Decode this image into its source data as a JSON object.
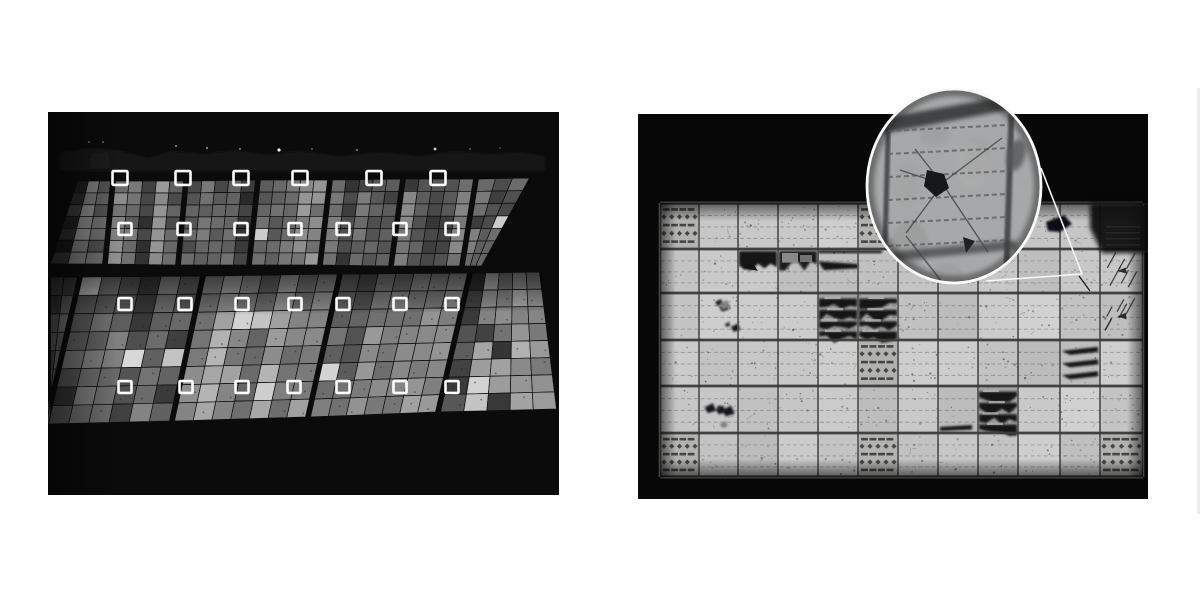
{
  "canvas": {
    "width": 1200,
    "height": 600,
    "background": "#ffffff"
  },
  "figure": {
    "left_label": "aerial electroluminescence image of solar farm with defect marker boxes",
    "right_label": "electroluminescence close-up of one PV module with magnifier inset on a cracked cell"
  },
  "left_photo": {
    "x": 48,
    "y": 112,
    "width": 511,
    "height": 383,
    "background": "#0b0b0b",
    "horizon": {
      "ridge": [
        [
          60,
          171
        ],
        [
          60,
          153
        ],
        [
          88,
          148
        ],
        [
          118,
          150
        ],
        [
          148,
          158
        ],
        [
          172,
          151
        ],
        [
          205,
          154
        ],
        [
          235,
          150
        ],
        [
          268,
          155
        ],
        [
          300,
          151
        ],
        [
          340,
          156
        ],
        [
          380,
          152
        ],
        [
          420,
          156
        ],
        [
          455,
          151
        ],
        [
          490,
          154
        ],
        [
          520,
          152
        ],
        [
          545,
          156
        ],
        [
          545,
          171
        ]
      ],
      "ridge_color": "#151515",
      "patch": [
        [
          90,
          168
        ],
        [
          92,
          153
        ],
        [
          108,
          152
        ],
        [
          110,
          168
        ]
      ],
      "patch_color": "#1e1e1e",
      "dots": [
        [
          89,
          142,
          0.9,
          0.5
        ],
        [
          103,
          142,
          0.9,
          0.5
        ],
        [
          176,
          146,
          1,
          0.55
        ],
        [
          207,
          148,
          1,
          0.6
        ],
        [
          240,
          149,
          1,
          0.5
        ],
        [
          279,
          150,
          1.6,
          0.95
        ],
        [
          312,
          149,
          0.9,
          0.45
        ],
        [
          357,
          150,
          1,
          0.5
        ],
        [
          435,
          149,
          1.4,
          0.8
        ],
        [
          470,
          149,
          0.9,
          0.45
        ],
        [
          500,
          148,
          0.8,
          0.4
        ]
      ]
    },
    "row_top": {
      "edges": [
        [
          75,
          181,
          48,
          264
        ],
        [
          113,
          181,
          105,
          264
        ],
        [
          186,
          181,
          178,
          265
        ],
        [
          258,
          180,
          249,
          265
        ],
        [
          330,
          180,
          320,
          265
        ],
        [
          403,
          179,
          391,
          266
        ],
        [
          476,
          179,
          462,
          266
        ],
        [
          532,
          178,
          484,
          266
        ]
      ],
      "cell_w": 12.5,
      "cell_rows": 7,
      "brightness": [
        0.8,
        0.95,
        0.9,
        1.0,
        0.92,
        0.88,
        0.9
      ]
    },
    "row_bottom": {
      "edges": [
        [
          48,
          277,
          48,
          425
        ],
        [
          80,
          277,
          46,
          424
        ],
        [
          203,
          276,
          172,
          421
        ],
        [
          340,
          274,
          308,
          417
        ],
        [
          470,
          273,
          438,
          412
        ],
        [
          542,
          272,
          559,
          409
        ]
      ],
      "cell_w": 19,
      "cell_rows": 8,
      "brightness": [
        0.72,
        0.9,
        1.0,
        0.93,
        1.2
      ],
      "shadow_band": [
        [
          48,
          277
        ],
        [
          542,
          272
        ],
        [
          544,
          310
        ],
        [
          48,
          318
        ]
      ]
    },
    "markers": {
      "stroke": "#fcfcfc",
      "stroke_width": 2.6,
      "rows": [
        {
          "cy": 178,
          "size": 15,
          "xs": [
            120,
            183,
            241,
            300,
            374,
            438
          ]
        },
        {
          "cy": 229,
          "size": 13,
          "xs": [
            125,
            184,
            241,
            295,
            343,
            400,
            452
          ]
        },
        {
          "cy": 304,
          "size": 13,
          "xs": [
            125,
            185,
            242,
            295,
            343,
            400,
            452
          ]
        },
        {
          "cy": 387,
          "size": 13,
          "xs": [
            125,
            186,
            242,
            294,
            343,
            400,
            452
          ]
        }
      ]
    }
  },
  "right_photo": {
    "x": 638,
    "y": 85,
    "width": 510,
    "height": 414,
    "photo_top": 114,
    "photo_bottom": 499,
    "background": "#070707",
    "module": {
      "col_edges": [
        660,
        699,
        738,
        778,
        818,
        858,
        898,
        938,
        978,
        1018,
        1060,
        1100,
        1143
      ],
      "row_edges": [
        203,
        249,
        293,
        340,
        386,
        433,
        477
      ],
      "cell_fill": "#c7c8c6",
      "grid_color": "#4c4c4a",
      "row_line_color": "#3b3b39",
      "busbar_color": "#5a5a58",
      "speckle_count": 560,
      "scratch_count": 55
    },
    "pattern_cells": [
      [
        0,
        0
      ],
      [
        0,
        5
      ],
      [
        3,
        5
      ],
      [
        5,
        0
      ],
      [
        5,
        5
      ],
      [
        5,
        11
      ]
    ],
    "defects": [
      {
        "row": 1,
        "col": 2,
        "type": "band"
      },
      {
        "row": 1,
        "col": 3,
        "type": "band-mixed"
      },
      {
        "row": 1,
        "col": 4,
        "type": "wedge-left"
      },
      {
        "row": 2,
        "col": 1,
        "type": "blobs"
      },
      {
        "row": 2,
        "col": 4,
        "type": "shatter"
      },
      {
        "row": 2,
        "col": 5,
        "type": "shatter"
      },
      {
        "row": 1,
        "col": 11,
        "type": "scratches"
      },
      {
        "row": 2,
        "col": 11,
        "type": "scratches"
      },
      {
        "row": 3,
        "col": 10,
        "type": "wedges"
      },
      {
        "row": 4,
        "col": 1,
        "type": "blobs"
      },
      {
        "row": 4,
        "col": 7,
        "type": "bottom-streak"
      },
      {
        "row": 4,
        "col": 8,
        "type": "shatter"
      }
    ],
    "corner_shadow": {
      "poly": [
        [
          1090,
          203
        ],
        [
          1148,
          203
        ],
        [
          1148,
          253
        ],
        [
          1102,
          253
        ],
        [
          1090,
          228
        ]
      ],
      "color": "#0a0a0a",
      "blob": [
        [
          1046,
          222
        ],
        [
          1064,
          215
        ],
        [
          1072,
          224
        ],
        [
          1060,
          232
        ],
        [
          1048,
          231
        ]
      ],
      "hint_area": [
        1106,
        226,
        34,
        24
      ]
    },
    "inset": {
      "cx": 954,
      "cy": 186,
      "rx": 87,
      "ry": 97,
      "ring_color": "#fafafa",
      "ring_width": 2.8,
      "fill": "#a6a8a9",
      "band_top": [
        [
          872,
          120
        ],
        [
          1030,
          92
        ],
        [
          1040,
          104
        ],
        [
          880,
          134
        ]
      ],
      "band_bottom": [
        [
          880,
          253
        ],
        [
          1015,
          240
        ],
        [
          1018,
          249
        ],
        [
          884,
          262
        ]
      ],
      "v_lines": [
        [
          889,
          104,
          884,
          281,
          5
        ],
        [
          1012,
          100,
          1006,
          279,
          6
        ]
      ],
      "busbar_y": [
        128,
        151,
        174,
        197,
        220,
        243
      ],
      "busbar_x": [
        888,
        1008
      ],
      "cracks": [
        [
          942,
          183,
          1002,
          138
        ],
        [
          942,
          183,
          988,
          252
        ],
        [
          942,
          185,
          906,
          233
        ],
        [
          940,
          181,
          915,
          149
        ],
        [
          906,
          236,
          950,
          292
        ],
        [
          900,
          170,
          930,
          180
        ]
      ],
      "blob": [
        [
          927,
          170
        ],
        [
          944,
          174
        ],
        [
          949,
          188
        ],
        [
          936,
          197
        ],
        [
          924,
          186
        ]
      ],
      "mark": [
        [
          963,
          237
        ],
        [
          975,
          241
        ],
        [
          966,
          253
        ]
      ],
      "side_patch": [
        1016,
        155,
        9,
        16
      ]
    },
    "callout": {
      "apex": [
        1082,
        274
      ],
      "upper": [
        1041,
        168
      ],
      "lower": [
        986,
        281
      ],
      "color": "#f6f6f6",
      "width": 1.6,
      "target_crack": [
        1079,
        276,
        1090,
        291
      ]
    }
  },
  "edge_artifact": {
    "x": 1197,
    "y": 88,
    "width": 3,
    "height": 426,
    "color": "#ebebeb"
  }
}
